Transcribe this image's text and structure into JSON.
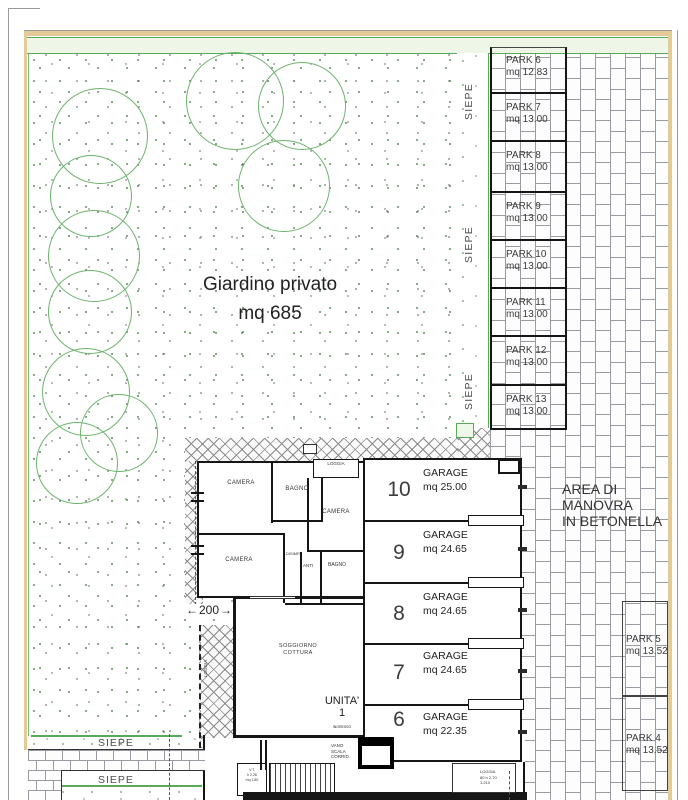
{
  "labels": {
    "siepe": "SIEPE",
    "dim_200": "200"
  },
  "garden": {
    "title": "Giardino privato",
    "area": "mq 685"
  },
  "parks_top": [
    {
      "name": "PARK 6",
      "mq": "mq 12.83"
    },
    {
      "name": "PARK 7",
      "mq": "mq 13.00"
    },
    {
      "name": "PARK 8",
      "mq": "mq 13.00"
    },
    {
      "name": "PARK 9",
      "mq": "mq 13.00"
    },
    {
      "name": "PARK 10",
      "mq": "mq 13.00"
    },
    {
      "name": "PARK 11",
      "mq": "mq 13.00"
    },
    {
      "name": "PARK 12",
      "mq": "mq 13.00"
    },
    {
      "name": "PARK 13",
      "mq": "mq 13.00"
    }
  ],
  "parks_right": [
    {
      "name": "PARK 5",
      "mq": "mq 13.52"
    },
    {
      "name": "PARK 4",
      "mq": "mq 13.52"
    }
  ],
  "maneuver": {
    "line1": "AREA DI",
    "line2": "MANOVRA",
    "line3": "IN BETONELLA"
  },
  "garages": [
    {
      "num": "10",
      "label": "GARAGE",
      "mq": "mq 25.00"
    },
    {
      "num": "9",
      "label": "GARAGE",
      "mq": "mq 24.65"
    },
    {
      "num": "8",
      "label": "GARAGE",
      "mq": "mq 24.65"
    },
    {
      "num": "7",
      "label": "GARAGE",
      "mq": "mq 24.65"
    },
    {
      "num": "6",
      "label": "GARAGE",
      "mq": "mq 22.35"
    }
  ],
  "apartment": {
    "camera1": "CAMERA",
    "bagno1": "BAGNO",
    "loggia_top": "LOGGIA",
    "camera2": "CAMERA",
    "camera3": "CAMERA",
    "disimp": "DISIMP.",
    "anti": "ANTI",
    "bagno2": "BAGNO",
    "soggiorno_l1": "SOGGIORNO",
    "soggiorno_l2": "COTTURA",
    "unit": "UNITA'",
    "unit_num": "1",
    "ingresso": "INGRESSO",
    "vano_l1": "VANO",
    "vano_l2": "SCALA",
    "vano_l3": "CORRID.",
    "vt_l1": "V.T.",
    "vt_l2": "h 2.28",
    "vt_l3": "mq 1.80",
    "loggia_balcony": "LOGGIA",
    "loggia_bottom_l1": "LOGGIA",
    "loggia_bottom_l2": "80 h 2.70",
    "loggia_bottom_l3": "1.210"
  },
  "colors": {
    "hedge_green": "#5aa85a",
    "tree_green": "#6db36d",
    "tan": "#e2cb96",
    "line_dark": "#1a1a1a"
  }
}
